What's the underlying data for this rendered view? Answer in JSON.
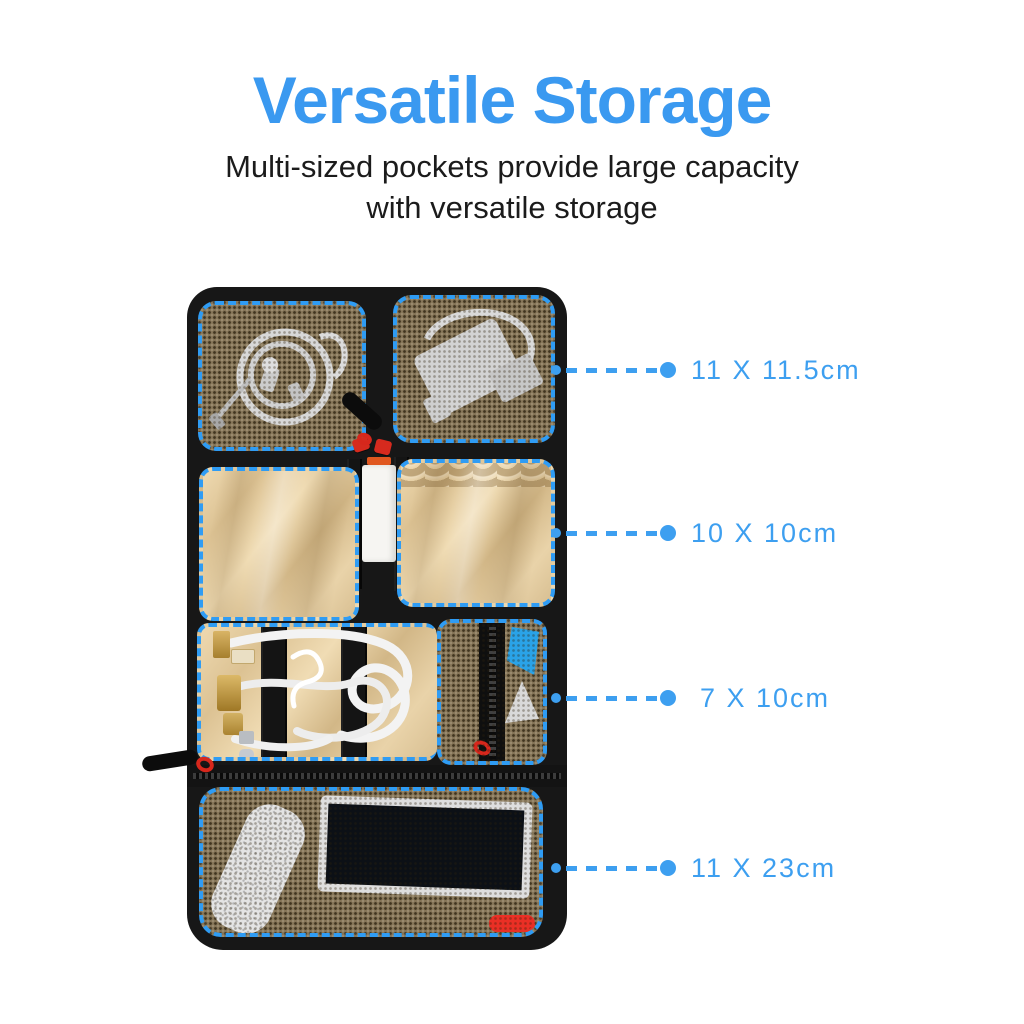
{
  "header": {
    "title": "Versatile Storage",
    "subtitle_line1": "Multi-sized pockets provide large capacity",
    "subtitle_line2": "with versatile storage"
  },
  "callouts": [
    {
      "label": "11 X 11.5cm"
    },
    {
      "label": "10 X 10cm"
    },
    {
      "label": "7 X 10cm"
    },
    {
      "label": "11 X 23cm"
    }
  ],
  "colors": {
    "title_blue": "#3a99f0",
    "callout_blue": "#3d9ff0",
    "dash_blue": "#2f9cf4",
    "bag_black": "#171717",
    "mesh_olive": "#847457",
    "tan_satin": "#e2ca9f",
    "accent_red": "#d62a1e"
  }
}
